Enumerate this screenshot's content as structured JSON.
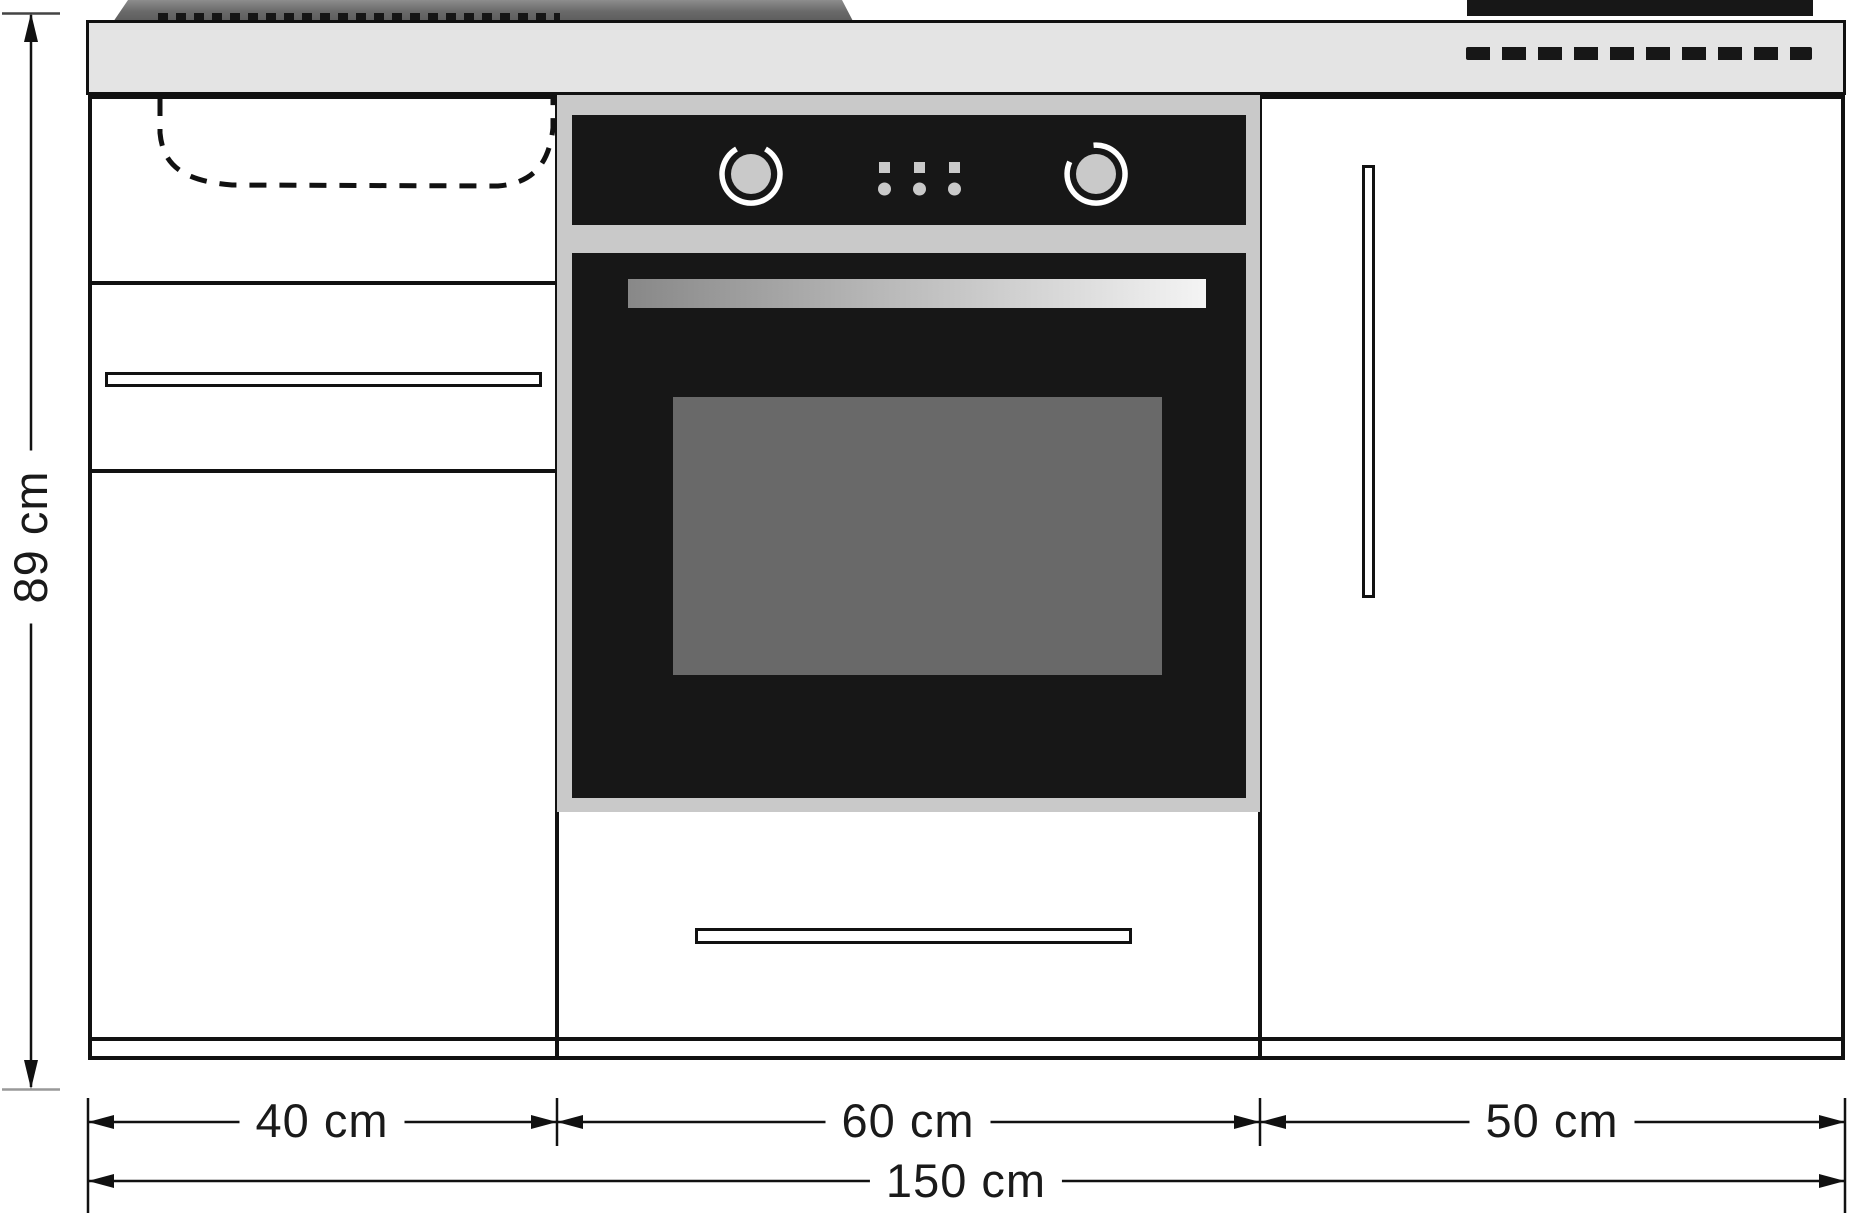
{
  "dimension_labels": {
    "height": "89 cm",
    "left_section_width": "40 cm",
    "middle_section_width": "60 cm",
    "right_section_width": "50 cm",
    "total_width": "150 cm"
  },
  "colors": {
    "counter_fill": "#e4e4e4",
    "drainboard_dark": "#6a6a6a",
    "drainboard_top": "#8d8d8d",
    "appliance_black": "#171717",
    "oven_frame_gray": "#c9c9c9",
    "oven_window_gray": "#696969",
    "knob_gray": "#c9c9c9",
    "outline_black": "#111111"
  }
}
